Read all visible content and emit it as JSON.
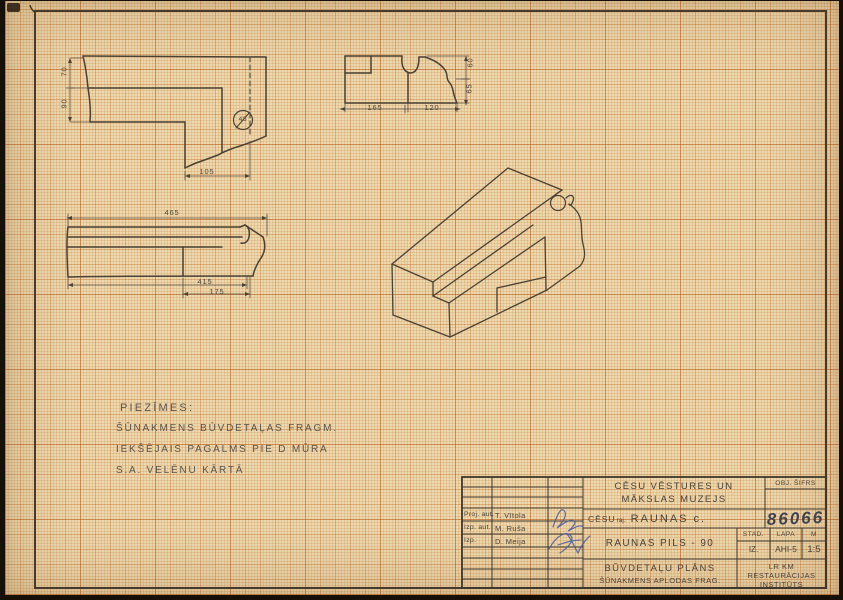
{
  "colors": {
    "paper": "#ecd9b0",
    "ink": "#4a4136",
    "grid_orange": "#c9792e",
    "signature_ink": "#4a5aa0",
    "pencil_number": "#3d4452"
  },
  "drawings": {
    "plan_fragment": {
      "dim_70": "70",
      "dim_90": "90",
      "dim_105": "105",
      "detail_circle_label": "45"
    },
    "profile_fragment": {
      "dim_165": "165",
      "dim_120": "120",
      "dim_60": "60",
      "dim_65": "65"
    },
    "long_profile": {
      "dim_465": "465",
      "dim_415": "415",
      "dim_175": "175"
    }
  },
  "notes": {
    "title": "PIEZĪMES:",
    "line1": "ŠŪNAKMENS BŪVDETAĻAS FRAGM.",
    "line2": "IEKŠĒJAIS PAGALMS PIE D MŪRA",
    "line3": "S.A. VELĒNU KĀRTĀ"
  },
  "title_block": {
    "museum_line1": "CĒSU VĒSTURES UN",
    "museum_line2": "MĀKSLAS MUZEJS",
    "object_code_label": "OBJ. ŠIFRS",
    "district": "CĒSU",
    "district_suffix": "raj.",
    "place": "RAUNAS c.",
    "object_number": "86066",
    "project_title": "RAUNAS PILS - 90",
    "stage_label": "STAD.",
    "sheet_label": "LAPA",
    "scale_label": "M",
    "stage_value": "IZ.",
    "sheet_value": "AHI-5",
    "scale_value": "1:5",
    "doc_title": "BŪVDETAĻU PLĀNS",
    "doc_subtitle": "ŠŪNAKMENS APLODAS FRAG.",
    "institute_line1": "LR KM",
    "institute_line2": "RESTAURĀCIJAS",
    "institute_line3": "INSTITŪTS",
    "people": [
      {
        "role": "Proj. aut.",
        "name": "T. Vītola"
      },
      {
        "role": "Izp. aut.",
        "name": "M. Ruša"
      },
      {
        "role": "Izp.",
        "name": "D. Meija"
      }
    ]
  }
}
